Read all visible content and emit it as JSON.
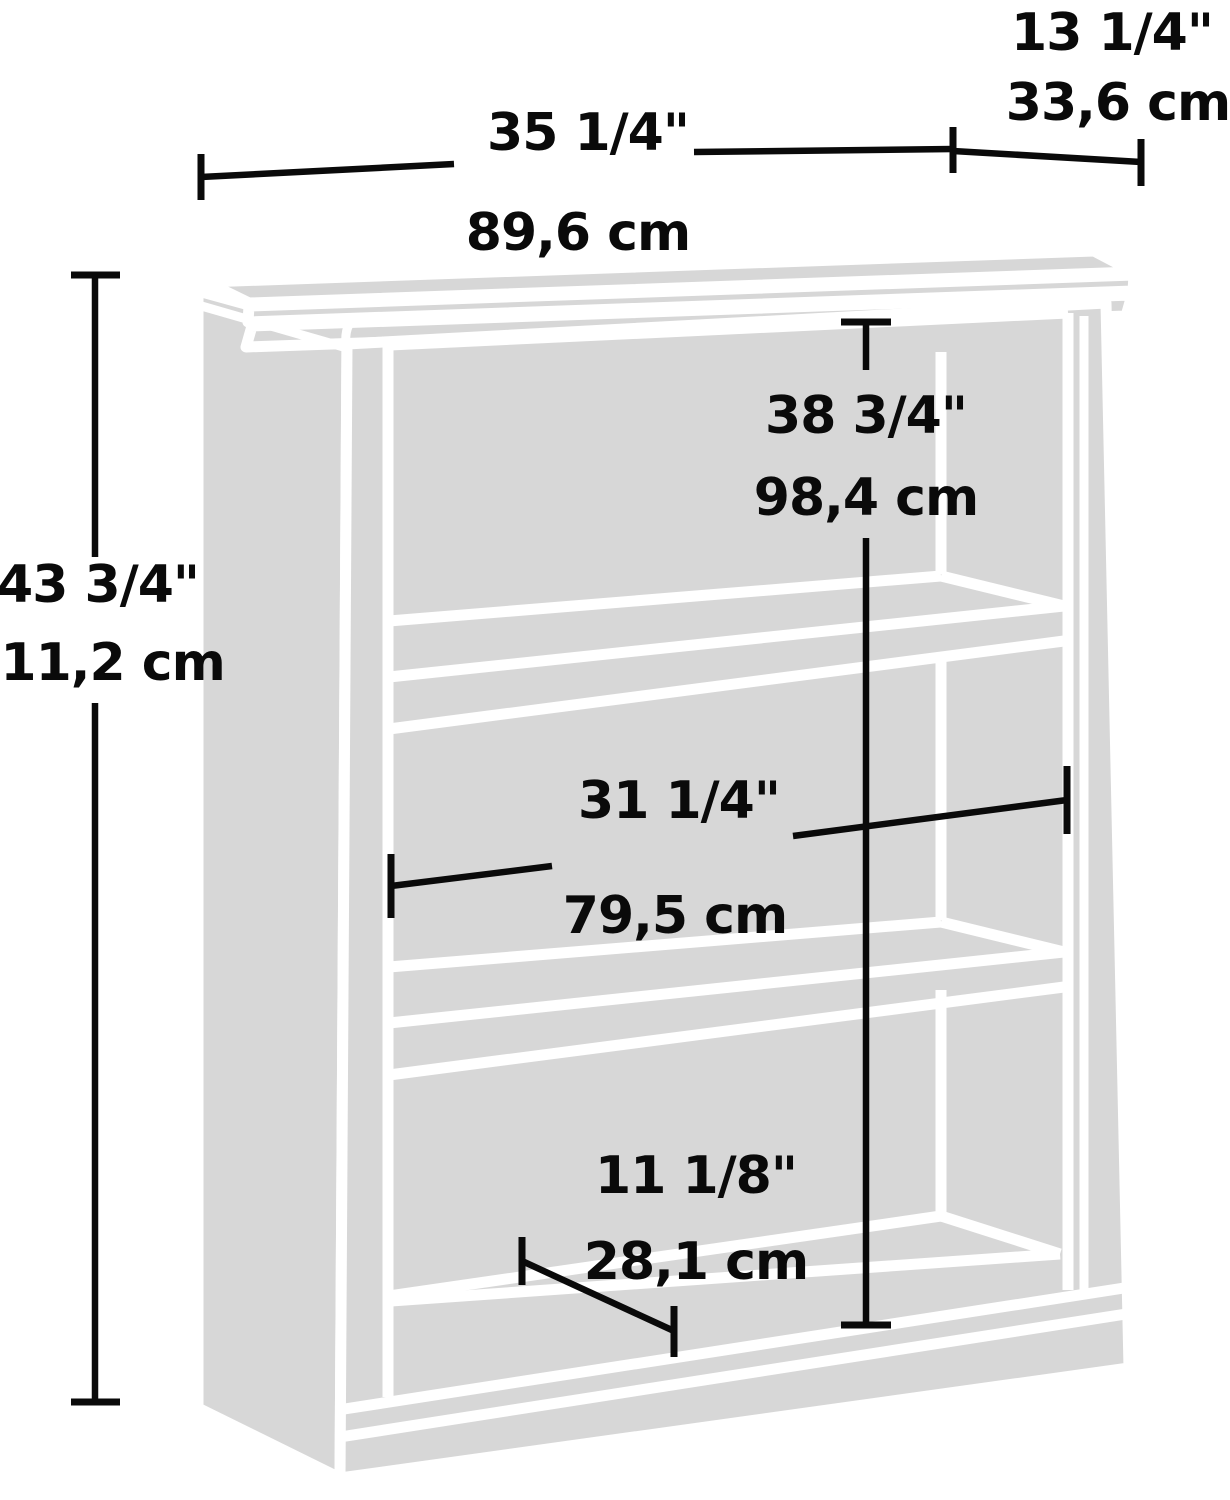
{
  "figure": {
    "kind": "bookcase-dimension-diagram",
    "shelf_count": 3
  },
  "colors": {
    "furniture_fill": "#d7d7d7",
    "furniture_line": "#ffffff",
    "dimension_line": "#0a0a0a",
    "background": "#ffffff"
  },
  "dimensions": {
    "overall_width": {
      "inches": "35 1/4\"",
      "metric": "89,6 cm"
    },
    "overall_depth": {
      "inches": "13 1/4\"",
      "metric": "33,6 cm"
    },
    "overall_height": {
      "inches": "43 3/4\"",
      "metric": "111,2 cm"
    },
    "interior_height": {
      "inches": "38 3/4\"",
      "metric": "98,4 cm"
    },
    "interior_width": {
      "inches": "31 1/4\"",
      "metric": "79,5 cm"
    },
    "shelf_depth": {
      "inches": "11 1/8\"",
      "metric": "28,1 cm"
    }
  }
}
